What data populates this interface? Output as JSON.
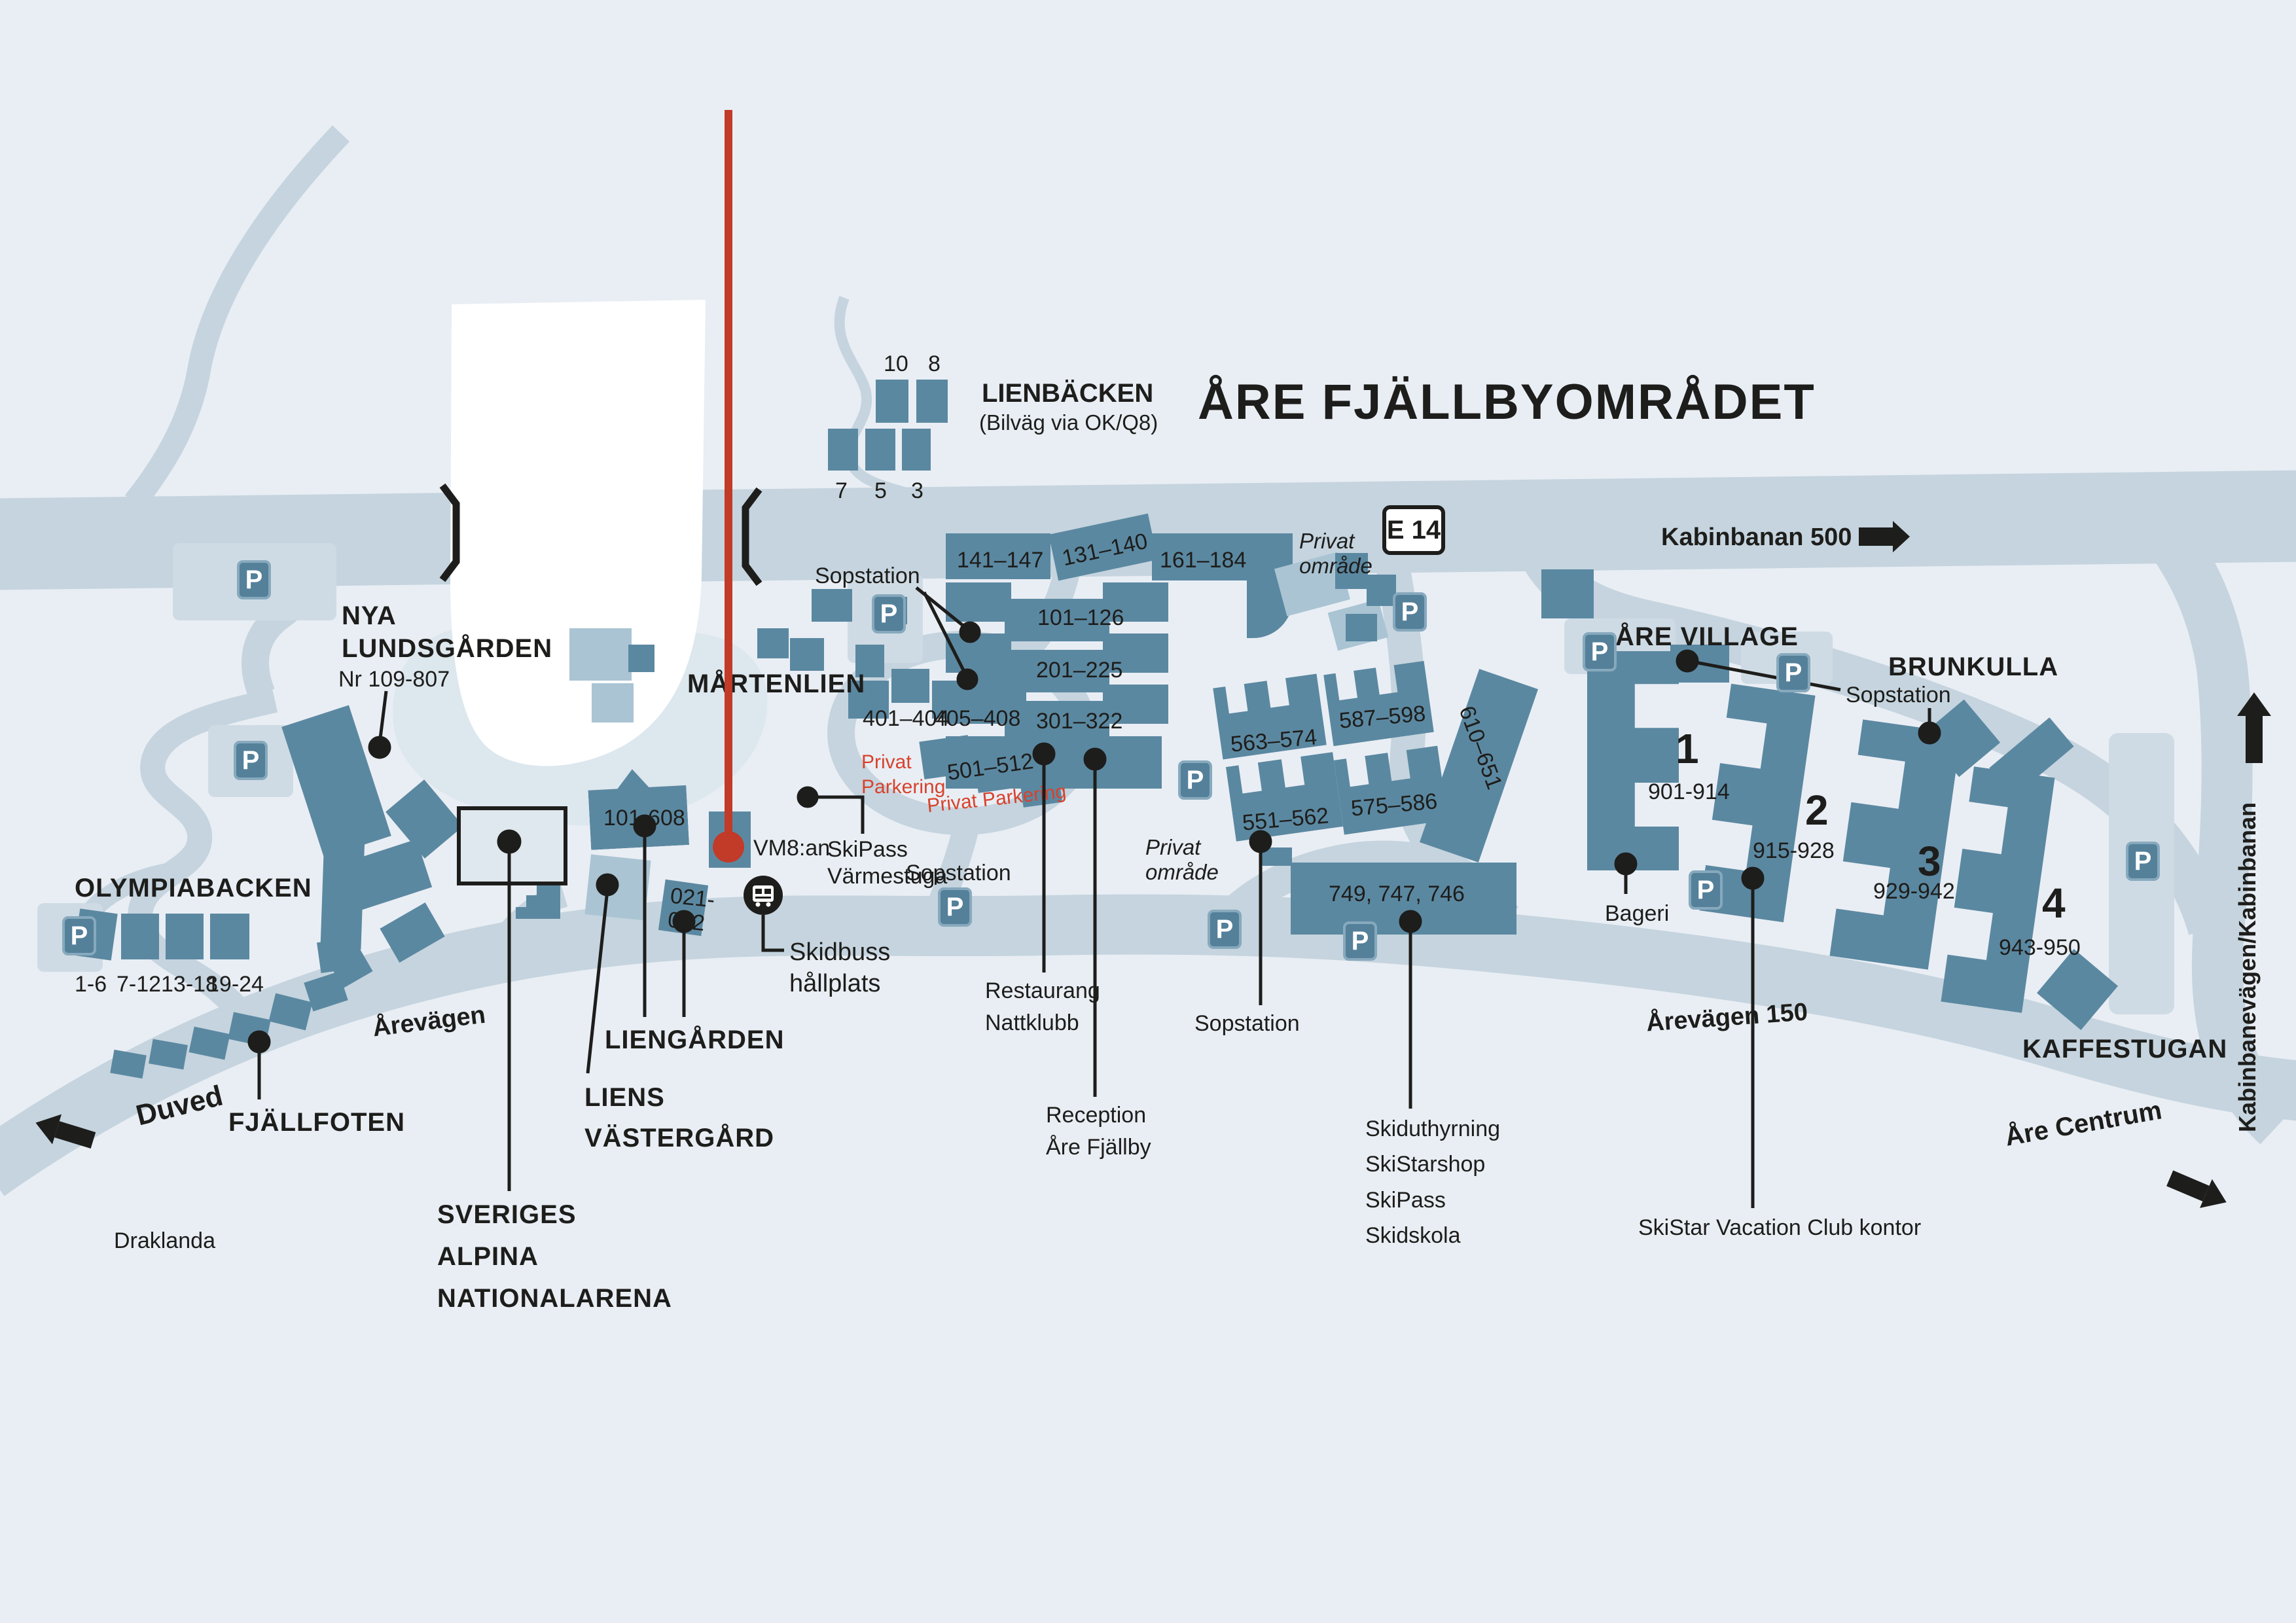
{
  "title": "ÅRE FJÄLLBYOMRÅDET",
  "parking": {
    "label": "P"
  },
  "signs": {
    "e14": "E 14",
    "kabinbanan": "Kabinbanan 500 m",
    "kabinbanevagen": "Kabinbanevägen/Kabinbanan",
    "are_centrum": "Åre Centrum",
    "arevagen_150": "Årevägen 150",
    "arevagen": "Årevägen",
    "duved": "Duved",
    "draklanda": "Draklanda"
  },
  "areas": {
    "lienbacken": {
      "name": "LIENBÄCKEN",
      "sub": "(Bilväg via OK/Q8)",
      "units": [
        "10",
        "8",
        "7",
        "5",
        "3"
      ]
    },
    "nya_lundsgarden": {
      "line1": "NYA",
      "line2": "LUNDSGÅRDEN",
      "sub": "Nr 109-807"
    },
    "martenlien": {
      "name": "MÅRTENLIEN"
    },
    "olympiabacken": {
      "name": "OLYMPIABACKEN",
      "units": [
        "1-6",
        "7-12",
        "13-18",
        "19-24"
      ]
    },
    "fjallfoten": {
      "name": "FJÄLLFOTEN"
    },
    "liengarden": {
      "name": "LIENGÅRDEN"
    },
    "liens_vastergard": {
      "line1": "LIENS",
      "line2": "VÄSTERGÅRD"
    },
    "sveriges_alpina": {
      "line1": "SVERIGES",
      "line2": "ALPINA",
      "line3": "NATIONALARENA"
    },
    "are_village": {
      "name": "ÅRE VILLAGE"
    },
    "brunkulla": {
      "name": "BRUNKULLA"
    },
    "kaffestugan": {
      "name": "KAFFESTUGAN"
    }
  },
  "buildings": {
    "r141": "141–147",
    "r131": "131–140",
    "r161": "161–184",
    "r101": "101–126",
    "r201": "201–225",
    "r301": "301–322",
    "r401": "401–404",
    "r405": "405–408",
    "r501": "501–512",
    "r563": "563–574",
    "r587": "587–598",
    "r551": "551–562",
    "r575": "575–586",
    "r610": "610–651",
    "r749": "749, 747, 746",
    "a101_608": "101-608",
    "a021_1": "021-",
    "a021_2": "022",
    "v1": {
      "num": "1",
      "range": "901-914"
    },
    "v2": {
      "num": "2",
      "range": "915-928"
    },
    "v3": {
      "num": "3",
      "range": "929-942"
    },
    "v4": {
      "num": "4",
      "range": "943-950"
    }
  },
  "poi": {
    "sopstation": "Sopstation",
    "privat_line1": "Privat",
    "privat_line2": "område",
    "privat_parkering_1": "Privat",
    "privat_parkering_2": "Parkering",
    "privat_parkering_inline": "Privat Parkering",
    "vm8an": "VM8:an",
    "skipass1": "SkiPass",
    "skipass2": "Värmestuga",
    "skidbuss1": "Skidbuss",
    "skidbuss2": "hållplats",
    "restaurang1": "Restaurang",
    "restaurang2": "Nattklubb",
    "reception1": "Reception",
    "reception2": "Åre Fjällby",
    "services": [
      "Skiduthyrning",
      "SkiStarshop",
      "SkiPass",
      "Skidskola"
    ],
    "skistar_kontor": "SkiStar Vacation Club kontor",
    "bageri": "Bageri"
  }
}
